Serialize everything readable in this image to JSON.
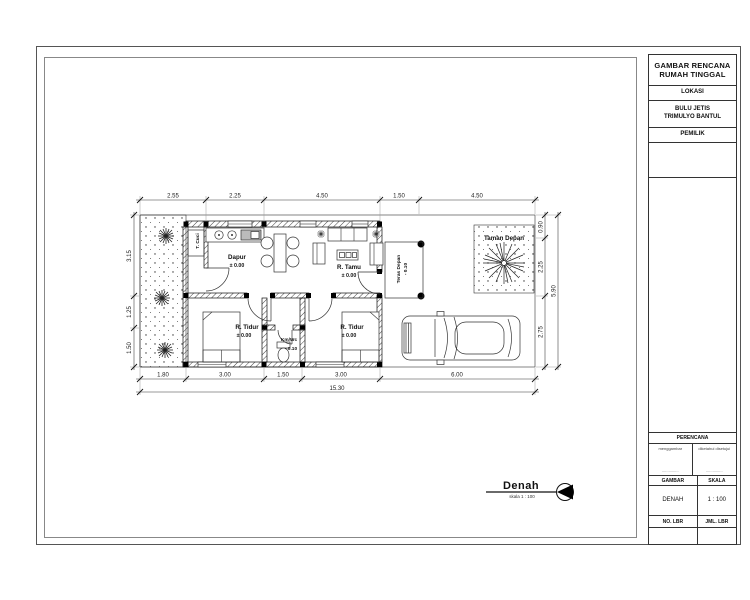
{
  "title_block": {
    "project_title_line1": "GAMBAR RENCANA",
    "project_title_line2": "RUMAH TINGGAL",
    "lokasi_label": "LOKASI",
    "lokasi_line1": "BULU JETIS",
    "lokasi_line2": "TRIMULYO BANTUL",
    "pemilik_label": "PEMILIK",
    "perencana_label": "PERENCANA",
    "perencana_col1": "menggambar",
    "perencana_col2": "diketahui  disetujui",
    "sig_dots1": "...............",
    "sig_dots2": "...............",
    "gambar_label": "GAMBAR",
    "skala_label": "SKALA",
    "gambar_value": "DENAH",
    "skala_value": "1 : 100",
    "no_lbr_label": "NO. LBR",
    "jml_lbr_label": "JML. LBR"
  },
  "drawing_title": {
    "name": "Denah",
    "scale_note": "skala 1 : 100"
  },
  "plan": {
    "rooms": {
      "t_cuci": "T. Cuci",
      "dapur": "Dapur",
      "dapur_level": "± 0.00",
      "r_tamu": "R. Tamu",
      "r_tamu_level": "± 0.00",
      "teras": "Teras Depan",
      "teras_level": "- 0.10",
      "taman": "Taman Depan",
      "r_tidur1": "R. Tidur",
      "r_tidur1_level": "± 0.00",
      "r_tidur2": "R. Tidur",
      "r_tidur2_level": "± 0.00",
      "kmwc": "Km/Wc",
      "kmwc_level": "- 0.10"
    },
    "dims_top": [
      "2.55",
      "2.25",
      "4.50",
      "1.50",
      "4.50"
    ],
    "dims_bottom": [
      "1.80",
      "3.00",
      "1.50",
      "3.00",
      "6.00"
    ],
    "dim_bottom_total": "15.30",
    "dims_left": [
      "3.15",
      "1.25",
      "1.50"
    ],
    "dims_right": [
      "0.90",
      "2.25",
      "2.75"
    ],
    "dim_right_total": "5.90"
  },
  "colors": {
    "line": "#1a1a1a",
    "paper": "#ffffff"
  }
}
